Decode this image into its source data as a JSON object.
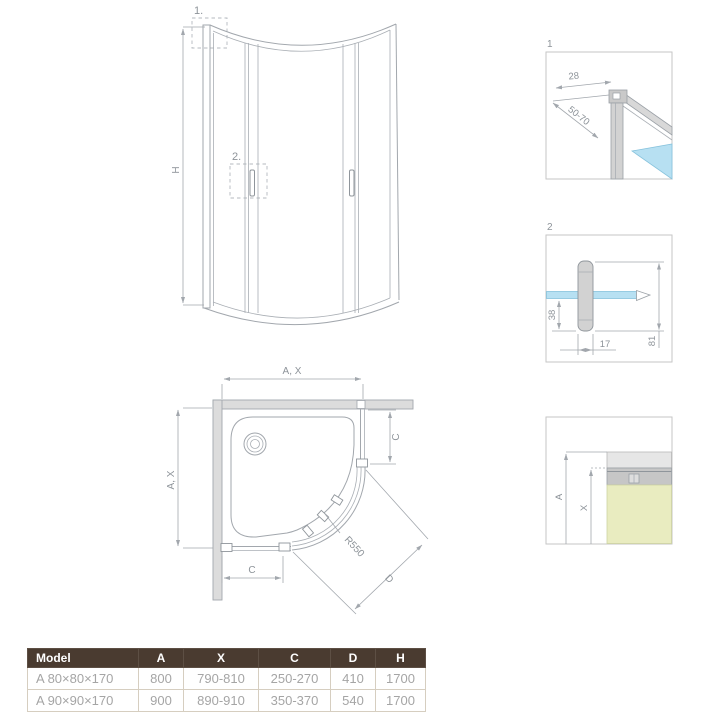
{
  "colors": {
    "line": "#a2a7ad",
    "dim_text": "#8d9399",
    "glass_blue": "#b7e0f2",
    "profile_gray": "#d2d2d2",
    "wall_gray": "#dcdcdc",
    "tray_yellow": "#e9ecc0",
    "table_header_bg": "#4a3b30",
    "table_header_text": "#ffffff",
    "table_row_text": "#a5a5a5",
    "table_border": "#d6cec0"
  },
  "front_view": {
    "callout_1": "1.",
    "callout_2": "2.",
    "dim_height": "H"
  },
  "plan_view": {
    "dim_width_top": "A, X",
    "dim_depth_left": "A, X",
    "dim_c_right": "C",
    "dim_c_bottom": "C",
    "radius_label": "R550",
    "dim_diagonal": "D"
  },
  "detail_1": {
    "label": "1",
    "dim_top_width": "28",
    "dim_adjust_range": "50-70"
  },
  "detail_2": {
    "label": "2",
    "dim_height_below": "38",
    "dim_handle_width": "17",
    "dim_handle_length": "81"
  },
  "detail_3": {
    "dim_a": "A",
    "dim_x": "X"
  },
  "spec_table": {
    "headers": [
      "Model",
      "A",
      "X",
      "C",
      "D",
      "H"
    ],
    "rows": [
      [
        "A 80×80×170",
        "800",
        "790-810",
        "250-270",
        "410",
        "1700"
      ],
      [
        "A 90×90×170",
        "900",
        "890-910",
        "350-370",
        "540",
        "1700"
      ]
    ]
  }
}
